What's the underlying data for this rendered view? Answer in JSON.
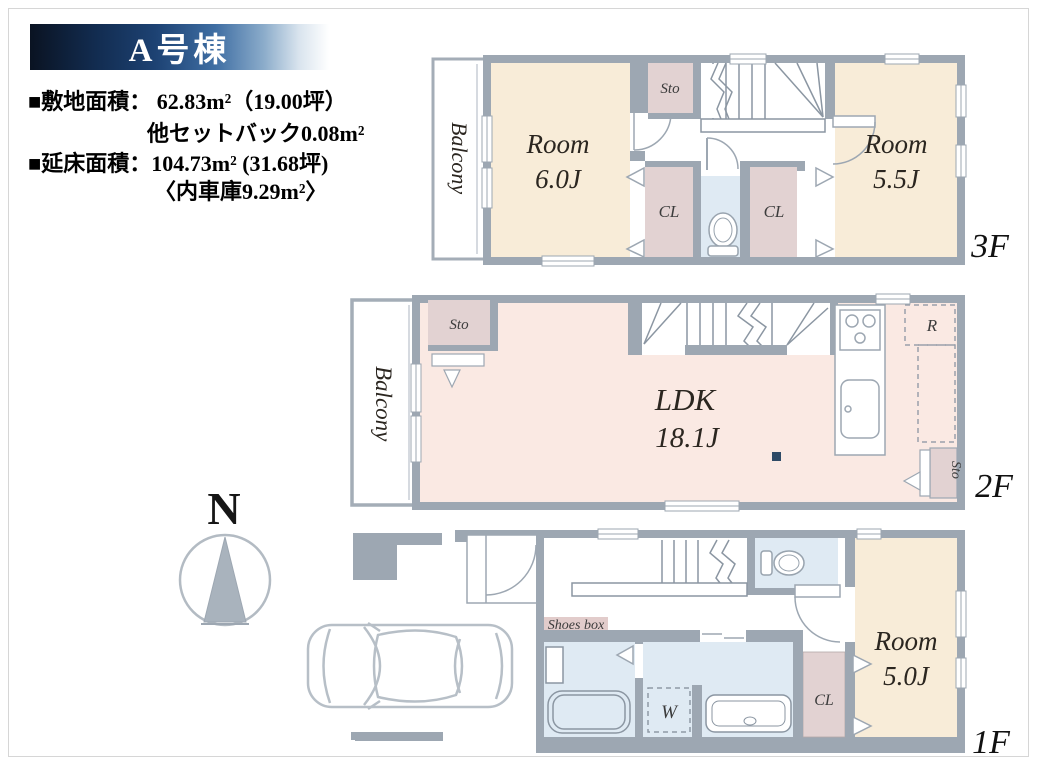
{
  "banner": {
    "title": "A号棟"
  },
  "info": {
    "site_area": "■敷地面積： 62.83m²（19.00坪）",
    "setback": "他セットバック0.08m²",
    "floor_area": "■延床面積：104.73m² (31.68坪)",
    "garage": "〈内車庫9.29m²〉"
  },
  "compass": {
    "north": "N"
  },
  "floor3": {
    "label": "3F",
    "balcony": "Balcony",
    "room_a_name": "Room",
    "room_a_size": "6.0J",
    "room_b_name": "Room",
    "room_b_size": "5.5J",
    "sto": "Sto",
    "cl_left": "CL",
    "cl_right": "CL"
  },
  "floor2": {
    "label": "2F",
    "balcony": "Balcony",
    "ldk_name": "LDK",
    "ldk_size": "18.1J",
    "sto_top": "Sto",
    "sto_bottom": "Sto",
    "refrigerator": "R"
  },
  "floor1": {
    "label": "1F",
    "shoes_box": "Shoes box",
    "room_name": "Room",
    "room_size": "5.0J",
    "cl": "CL",
    "washer": "W"
  },
  "colors": {
    "banner_dark": "#0a1322",
    "banner_mid": "#1d4273",
    "wall_gray": "#9da7b2",
    "room_cream": "#f8ecd8",
    "ldk_pink": "#fae9e3",
    "closet_pink": "#e2d2d2",
    "bath_blue": "#dfeaf3",
    "shoes_pink": "#e2cccb",
    "marker_navy": "#2e4a66"
  }
}
